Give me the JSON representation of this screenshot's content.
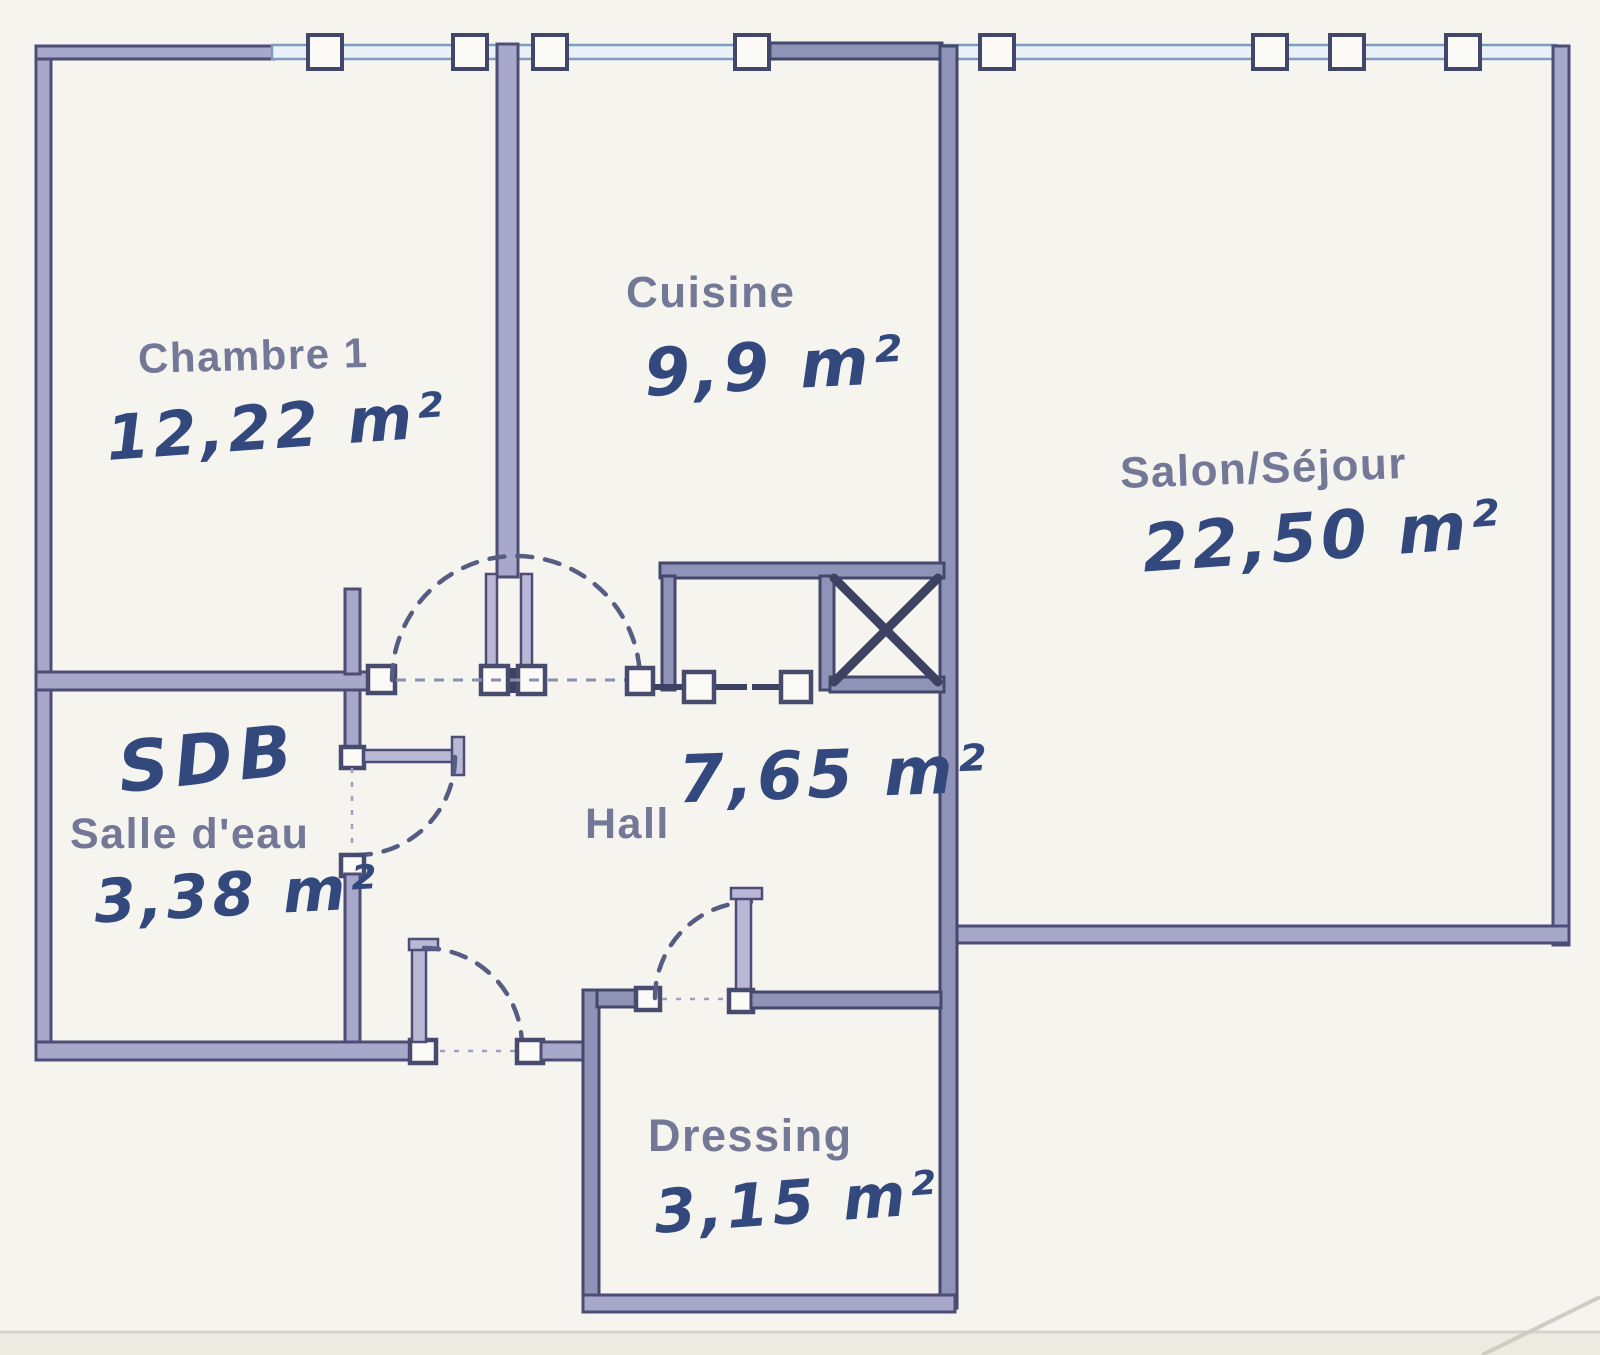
{
  "plan": {
    "rooms": [
      {
        "name": "Chambre 1",
        "area": "12,22 m²"
      },
      {
        "name": "Cuisine",
        "area": "9,9 m²"
      },
      {
        "name": "Salon/Séjour",
        "area": "22,50 m²"
      },
      {
        "name": "Salle d'eau",
        "abbrev": "SDB",
        "area": "3,38 m²"
      },
      {
        "name": "Hall",
        "area": "7,65 m²"
      },
      {
        "name": "Dressing",
        "area": "3,15 m²"
      }
    ]
  },
  "colors": {
    "paper": "#f6f4ef",
    "wall_fill": "#a8a8ca",
    "wall_edge": "#4d4d77",
    "window_line": "#7d9cc0",
    "handwriting_ink": "#33497d",
    "printed_label": "#6a6e90"
  }
}
